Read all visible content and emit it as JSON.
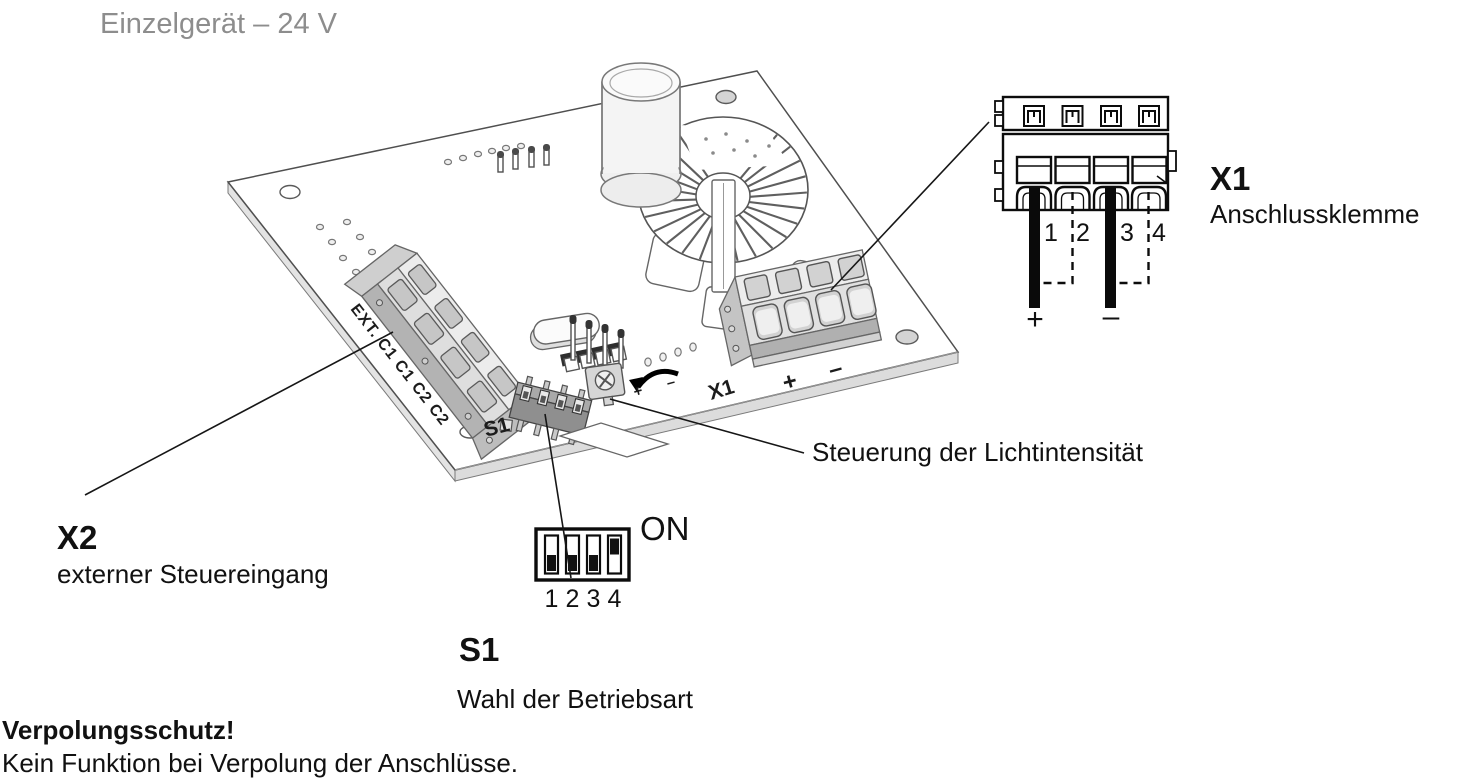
{
  "title": "Einzelgerät – 24 V",
  "board_silkscreen": {
    "ext_connector": "EXT.  C1 C1 C2 C2",
    "s1": "S1",
    "x1": "X1",
    "x1_plus": "+",
    "x1_minus": "–",
    "pot_plus": "+",
    "pot_minus": "–"
  },
  "x1_detail": {
    "designator": "X1",
    "label": "Anschlussklemme",
    "terminals": [
      "1",
      "2",
      "3",
      "4"
    ],
    "wire_plus": "+",
    "wire_minus": "–"
  },
  "s1_detail": {
    "designator": "S1",
    "label": "Wahl der Betriebsart",
    "on_label": "ON",
    "switches": [
      "1",
      "2",
      "3",
      "4"
    ],
    "states": [
      "off",
      "off",
      "off",
      "on"
    ]
  },
  "x2_callout": {
    "designator": "X2",
    "label": "externer Steuereingang"
  },
  "pot_callout": {
    "label": "Steuerung der Lichtintensität"
  },
  "warning": {
    "heading": "Verpolungsschutz!",
    "body": "Kein Funktion bei Verpolung der Anschlüsse."
  }
}
